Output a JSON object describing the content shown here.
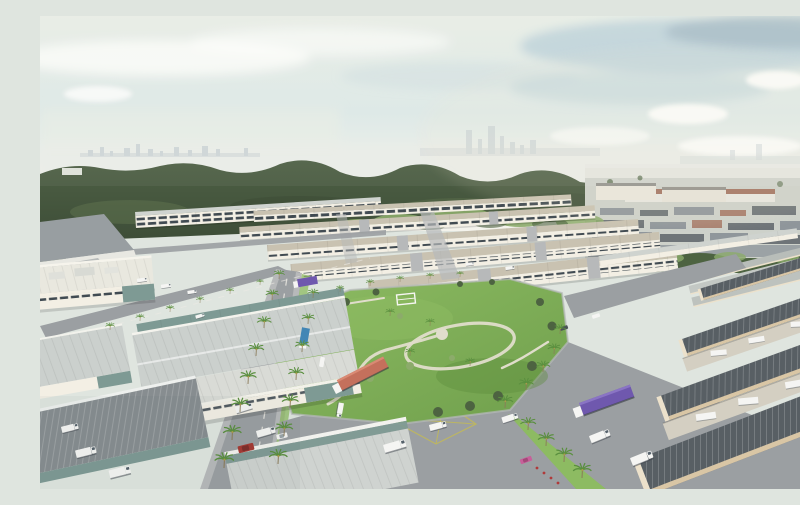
{
  "scene": {
    "title": "Aerial rendering of an industrial park development",
    "description": "Aerial 3D architectural rendering of a master-planned industrial estate: rows of white semi-detached factory and warehouse units arranged around a central landscaped park with winding footpaths and palm trees, palm-lined boulevards with box trucks and semi-trailers, large foreground warehouses with glass clerestories and loading yards, a dark green forest belt and an older industrial town behind the estate, and a hazy city skyline under a pale cloudy sky",
    "layers": [
      "sky",
      "city-skyline",
      "forest-belt",
      "distant-industrial-town",
      "greenbelt",
      "new-industrial-estate",
      "central-park",
      "boulevards-and-roads",
      "foreground-warehouses",
      "loading-yards",
      "vehicles",
      "palm-trees"
    ]
  },
  "colors": {
    "sky_top": "#e8ede5",
    "sky_mid": "#dde8e6",
    "sky_horizon": "#f1f1ea",
    "cloud_white": "#fdfdfb",
    "cloud_blue": "#bad0d8",
    "cloud_dark": "#a3b8c1",
    "haze": "#e9ece7",
    "city_silhouette": "#b9c3c9",
    "forest_dark": "#3d4d37",
    "forest_mid": "#4e6045",
    "forest_light": "#647751",
    "distant_ground": "#cdd1ca",
    "distant_wall": "#e7e6df",
    "distant_roof_gray": "#8f969b",
    "distant_roof_red": "#9c6753",
    "distant_roof_dark": "#6e7478",
    "tree_light": "#8cab6b",
    "tree_dark": "#4d6341",
    "estate_wall": "#f3efe4",
    "estate_wall_shade": "#dcd7c8",
    "estate_roof": "#cfd3cf",
    "estate_roof_warm": "#c9c2b1",
    "estate_roof_shade": "#b8bdb9",
    "estate_window": "#414b52",
    "road": "#9b9fa2",
    "road_light": "#b7b9ba",
    "road_line": "#eceae4",
    "marking_yellow": "#c2ba58",
    "park_green": "#6f9f4c",
    "park_green_light": "#8dbb62",
    "park_green_dark": "#5d8c3d",
    "path_cream": "#e0ddcb",
    "glass_teal": "#7e9a94",
    "concrete": "#d4cfc2",
    "fg_roof_gray": "#cbd0cd",
    "fg_roof_dark": "#585f64",
    "fascia_beige": "#d9c6a5",
    "gable_cream": "#ece1cb",
    "palm_trunk": "#8a7a58",
    "palm_frond": "#5a8f3f",
    "palm_tinge": "#c9a050",
    "truck_white": "#f5f5f3",
    "truck_purple": "#6f58ae",
    "truck_blue": "#4286b5",
    "truck_red": "#c4705c",
    "car_red": "#a53a34",
    "car_pink": "#c7609a",
    "flower_red": "#b03a3a"
  }
}
